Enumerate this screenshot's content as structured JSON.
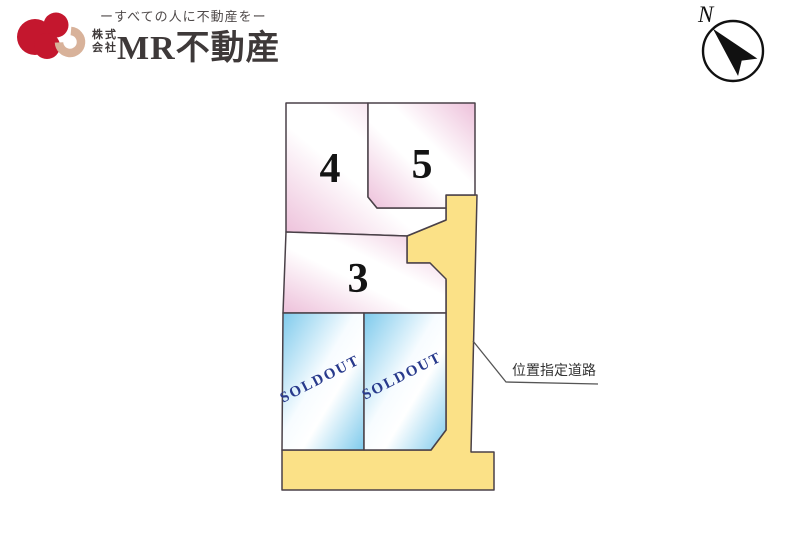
{
  "header": {
    "tagline": "ーすべての人に不動産をー",
    "company_prefix": [
      "株式",
      "会社"
    ],
    "company_name": "MR不動産"
  },
  "compass": {
    "label": "N"
  },
  "diagram": {
    "road_label": "位置指定道路",
    "colors": {
      "pink_edge": "#edc0da",
      "pink_mid": "#ffffff",
      "blue_edge": "#7ecaec",
      "blue_mid": "#f7fcff",
      "road_fill": "#fbe187",
      "outline": "#4a4148",
      "soldout_text": "#283a8c",
      "logo_red": "#c4172e",
      "logo_beige": "#d8b29a"
    },
    "lots": [
      {
        "id": "lot-4",
        "number": "4",
        "status": "available",
        "points": "286,103 368,103 368,197 377,208 446,208 446,220 407,236 286,232",
        "label": {
          "x": 330,
          "y": 167
        }
      },
      {
        "id": "lot-5",
        "number": "5",
        "status": "available",
        "points": "368,103 475,103 475,195 446,195 446,208 377,208 368,197",
        "label": {
          "x": 422,
          "y": 163
        }
      },
      {
        "id": "lot-3",
        "number": "3",
        "status": "available",
        "points": "286,232 407,236 407,263 430,263 446,279 446,313 283,313",
        "label": {
          "x": 358,
          "y": 277
        }
      },
      {
        "id": "lot-sold-left",
        "number": "SOLDOUT",
        "status": "sold",
        "points": "283,313 364,313 364,450 282,450",
        "label": {
          "x": 322,
          "y": 383,
          "rotate": -27
        }
      },
      {
        "id": "lot-sold-right",
        "number": "SOLDOUT",
        "status": "sold",
        "points": "364,313 446,313 446,430 431,450 364,450",
        "label": {
          "x": 404,
          "y": 380,
          "rotate": -27
        }
      }
    ],
    "road": {
      "points": "446,195 477,195 471,452 494,452 494,490 282,490 282,450 431,450 446,430 446,280 430,263 407,263 407,236 446,220"
    },
    "leader": {
      "points": "473,341 506,382 598,384",
      "label_x": 512,
      "label_y": 375
    }
  }
}
